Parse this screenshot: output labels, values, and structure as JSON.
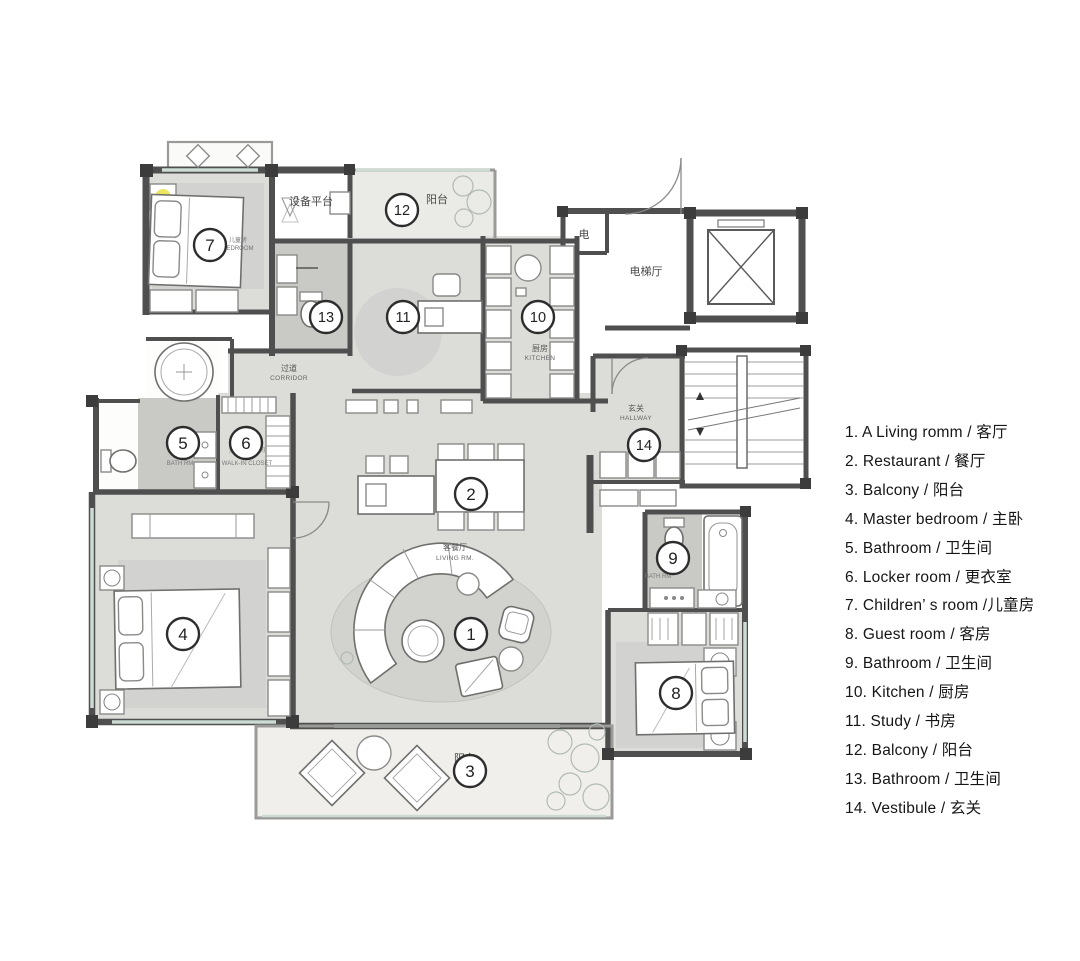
{
  "plan": {
    "markers": [
      {
        "number": "1"
      },
      {
        "number": "2"
      },
      {
        "number": "3"
      },
      {
        "number": "4"
      },
      {
        "number": "5"
      },
      {
        "number": "6"
      },
      {
        "number": "7"
      },
      {
        "number": "8"
      },
      {
        "number": "9"
      },
      {
        "number": "10"
      },
      {
        "number": "11"
      },
      {
        "number": "12"
      },
      {
        "number": "13"
      },
      {
        "number": "14"
      }
    ],
    "labels": {
      "equipment_platform": "设备平台",
      "balcony_top": "阳台",
      "electrical": "电",
      "elevator_hall": "电梯厅",
      "kitchen_zh": "厨房",
      "kitchen_en": "KITCHEN",
      "corridor_zh": "过道",
      "corridor_en": "CORRIDOR",
      "hallway_zh": "玄关",
      "hallway_en": "HALLWAY",
      "living_zh": "客餐厅",
      "living_en": "LIVING RM.",
      "bath5_en": "BATH RM",
      "closet_zh": "步入式衣帽间",
      "closet_en": "WALK-IN CLOSET",
      "bedroom7_zh": "儿童房",
      "bedroom7_en": "BEDROOM",
      "bath9_en": "BATH RM",
      "balcony_bottom": "阳台"
    },
    "colors": {
      "wall": "#4f4f4f",
      "room_fill": "#dcdcd9",
      "bath_fill": "#c9c9c6",
      "window_tint": "#ccdcd4",
      "accent_yellow": "#e8e044"
    }
  },
  "legend": {
    "items": [
      {
        "text": "1. A Living romm / 客厅"
      },
      {
        "text": "2. Restaurant / 餐厅"
      },
      {
        "text": "3. Balcony / 阳台"
      },
      {
        "text": "4. Master bedroom / 主卧"
      },
      {
        "text": "5. Bathroom / 卫生间"
      },
      {
        "text": "6. Locker room / 更衣室"
      },
      {
        "text": "7. Children’ s room /儿童房"
      },
      {
        "text": "8. Guest room / 客房"
      },
      {
        "text": "9. Bathroom / 卫生间"
      },
      {
        "text": "10. Kitchen / 厨房"
      },
      {
        "text": "11. Study / 书房"
      },
      {
        "text": "12. Balcony / 阳台"
      },
      {
        "text": "13. Bathroom / 卫生间"
      },
      {
        "text": "14. Vestibule / 玄关"
      }
    ]
  }
}
